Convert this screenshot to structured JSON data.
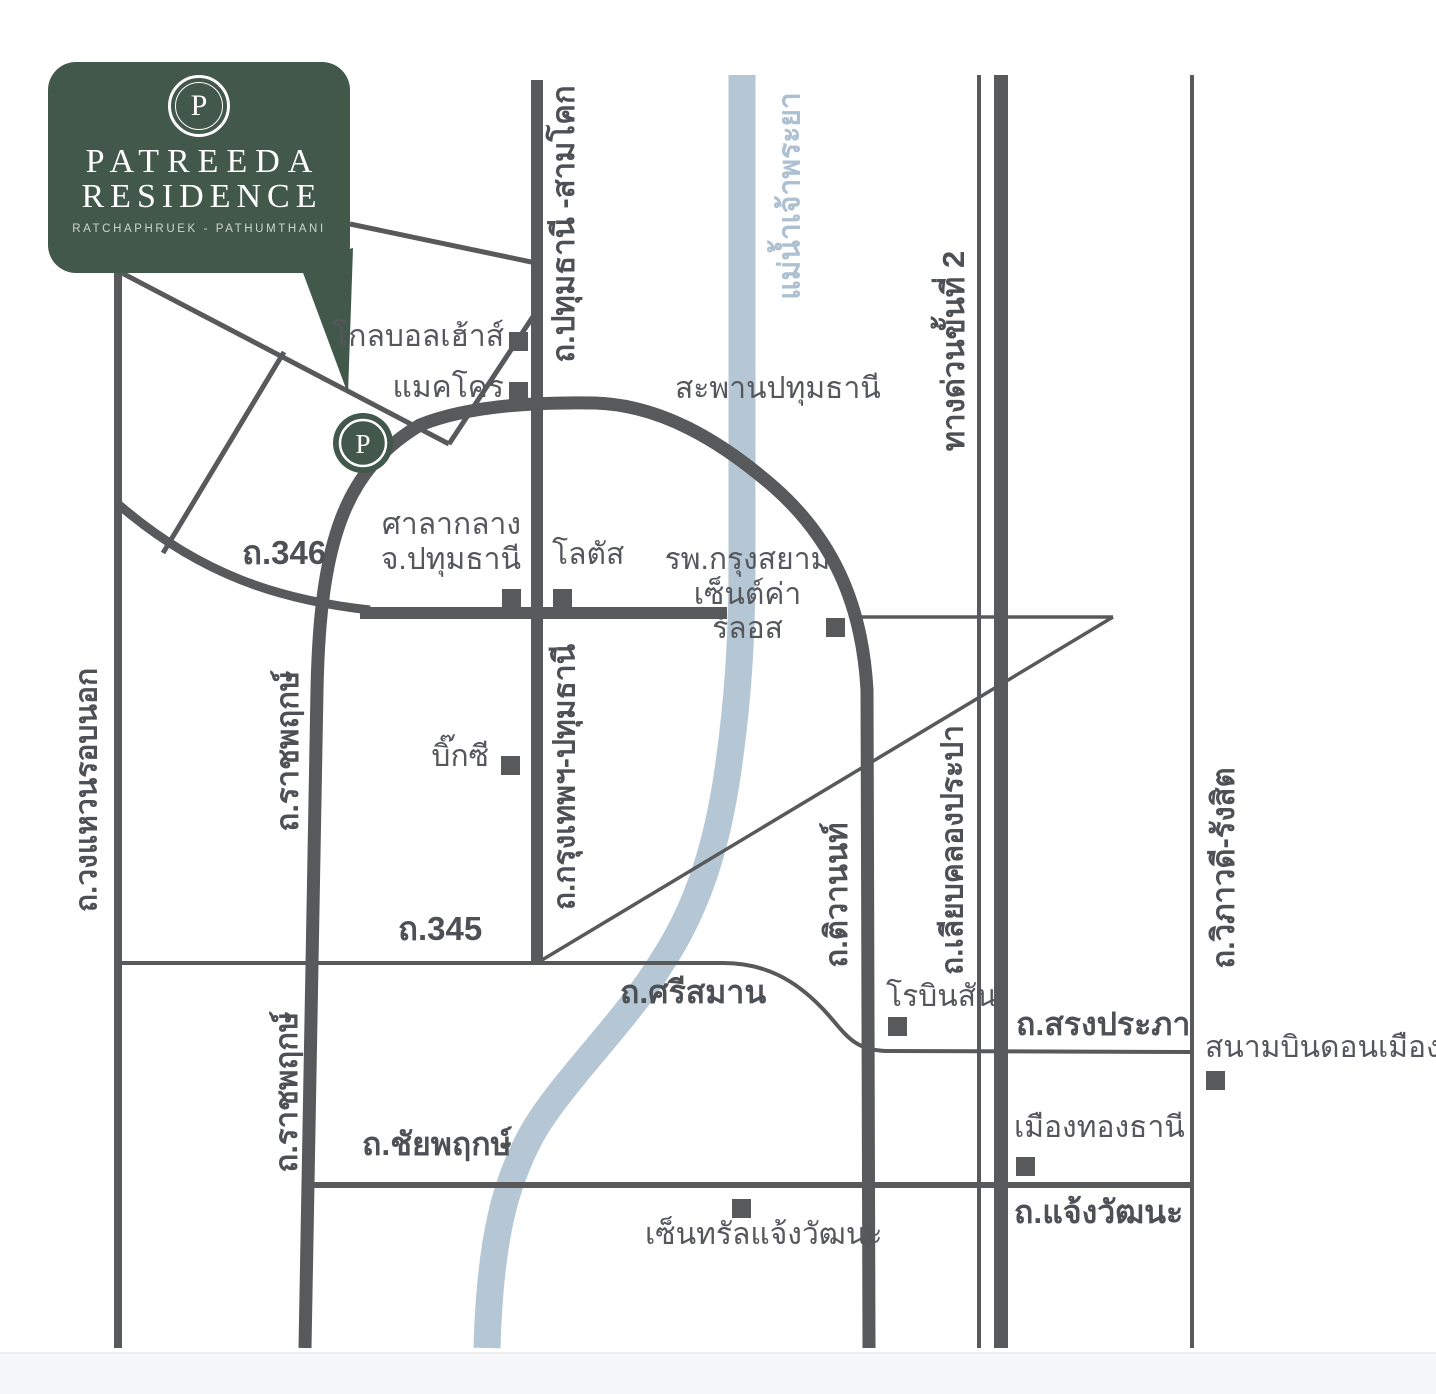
{
  "brand": {
    "name_line1": "PATREEDA",
    "name_line2": "RESIDENCE",
    "subtitle": "RATCHAPHRUEK - PATHUMTHANI",
    "monogram": "P"
  },
  "colors": {
    "brand_green": "#42584a",
    "road_gray": "#58595b",
    "label_gray": "#55575c",
    "river_blue": "#b5c7d5",
    "river_label_blue": "#adc0d1"
  },
  "river": {
    "name": "แม่น้ำเจ้าพระยา"
  },
  "bridge": {
    "name": "สะพานปทุมธานี"
  },
  "roads": {
    "pathumthani_samkhok": "ถ.ปทุมธานี -สามโคก",
    "r346": "ถ.346",
    "r345": "ถ.345",
    "outer_ring": "ถ.วงแหวนรอบนอก",
    "ratchaphruek_upper": "ถ.ราชพฤกษ์",
    "ratchaphruek_lower": "ถ.ราชพฤกษ์",
    "krungthep_pathumthani": "ถ.กรุงเทพฯ-ปทุมธานี",
    "tiwanon": "ถ.ติวานนท์",
    "liab_khlong_prapa": "ถ.เลียบคลองประปา",
    "expressway_stage2": "ทางด่วนขั้นที่ 2",
    "viphavadi_rangsit": "ถ.วิภาวดี-รังสิต",
    "srisaman": "ถ.ศรีสมาน",
    "songprapha": "ถ.สรงประภา",
    "chaiyaphruek": "ถ.ชัยพฤกษ์",
    "chaengwatthana": "ถ.แจ้งวัฒนะ"
  },
  "places": {
    "global_house": "โกลบอลเฮ้าส์",
    "makro": "แมคโคร",
    "city_hall_line1": "ศาลากลาง",
    "city_hall_line2": "จ.ปทุมธานี",
    "lotus": "โลตัส",
    "hospital_line1": "รพ.กรุงสยาม",
    "hospital_line2": "เซ็นต์ค่าร์ลอส",
    "big_c": "บิ๊กซี",
    "robinson": "โรบินสัน",
    "don_mueang_airport": "สนามบินดอนเมือง",
    "muang_thong_thani": "เมืองทองธานี",
    "central_chaengwatthana": "เซ็นทรัลแจ้งวัฒนะ"
  }
}
